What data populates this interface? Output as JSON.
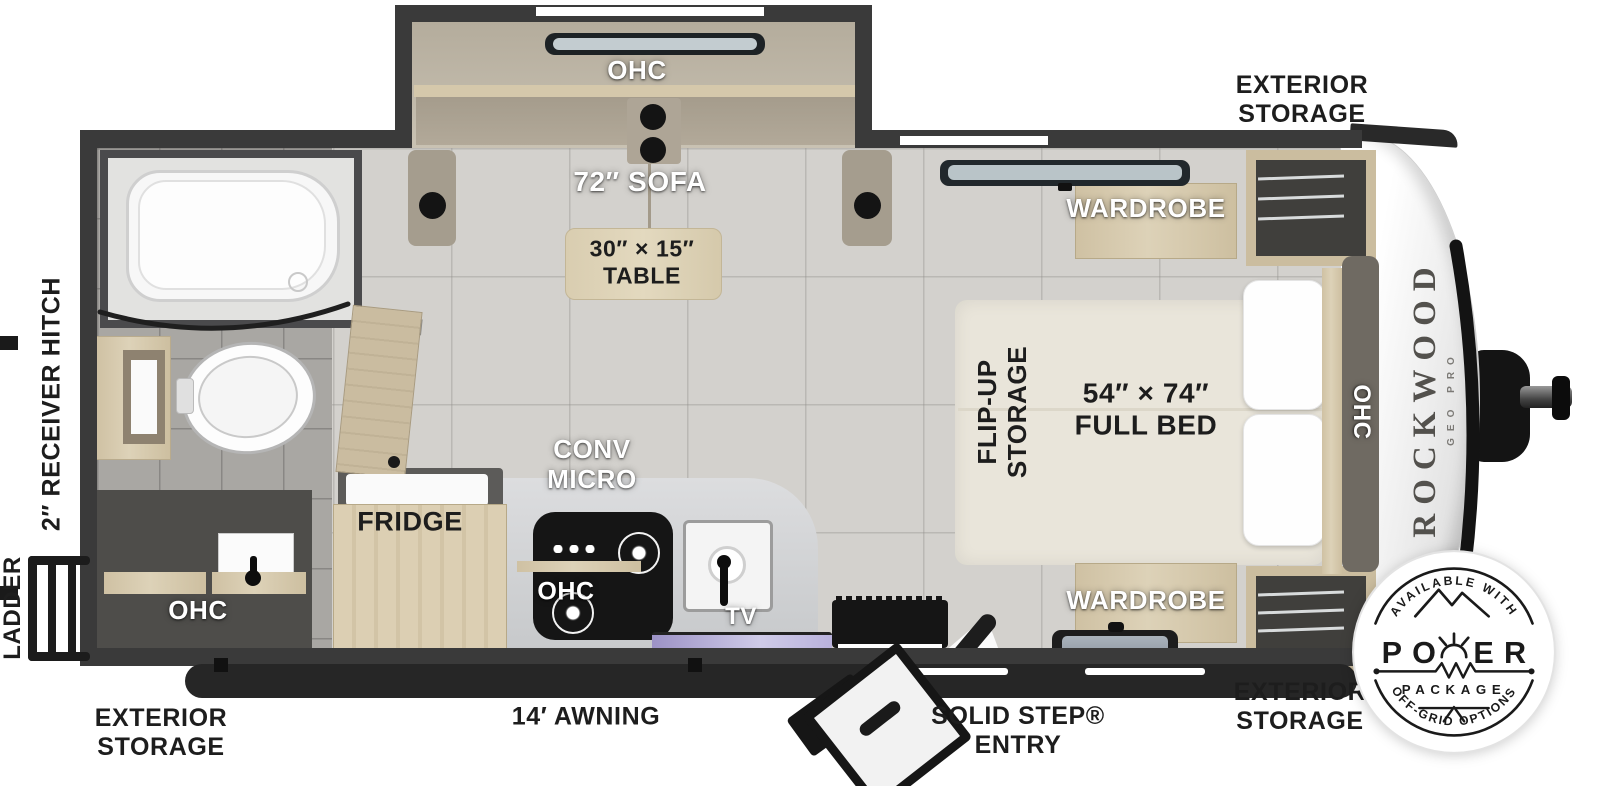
{
  "title": "Rockwood Geo Pro travel trailer floor plan",
  "brand": {
    "name": "ROCKWOOD",
    "model": "GEO PRO"
  },
  "exterior_labels": {
    "storage_top_right": {
      "line1": "EXTERIOR",
      "line2": "STORAGE"
    },
    "storage_bottom_left": {
      "line1": "EXTERIOR",
      "line2": "STORAGE"
    },
    "storage_bottom_right": {
      "line1": "EXTERIOR",
      "line2": "STORAGE"
    },
    "awning": "14′ AWNING",
    "entry": {
      "line1": "SOLID STEP®",
      "line2": "ENTRY"
    },
    "receiver_hitch": "2″ RECEIVER HITCH",
    "ladder": "LADDER"
  },
  "interior_labels": {
    "ohc_slide": "OHC",
    "sofa": "72″ SOFA",
    "table": {
      "line1": "30″ × 15″",
      "line2": "TABLE"
    },
    "wardrobe_top": "WARDROBE",
    "wardrobe_bottom": "WARDROBE",
    "flip_up": {
      "line1": "FLIP-UP",
      "line2": "STORAGE"
    },
    "bed": {
      "line1": "54″ × 74″",
      "line2": "FULL BED"
    },
    "ohc_bed": "OHC",
    "ohc_bath": "OHC",
    "fridge": "FRIDGE",
    "conv_micro": {
      "line1": "CONV",
      "line2": "MICRO"
    },
    "ohc_kitchen": "OHC",
    "tv": "TV"
  },
  "badge": {
    "top": "AVAILABLE WITH",
    "power_left": "PO",
    "power_right": "ER",
    "package": "PACKAGE",
    "bottom": "OFF-GRID OPTIONS"
  },
  "colors": {
    "wall": "#3a3a3a",
    "floor": "#d3d1cd",
    "bath_floor": "#a9a7a3",
    "wood": "#d6c9ad",
    "sofa": "#b3aa9a",
    "bed": "#e9e5da",
    "appliance_dark": "#161616",
    "front_cap": "#f2f2f2",
    "glass_purple": "#b3a9d9"
  }
}
